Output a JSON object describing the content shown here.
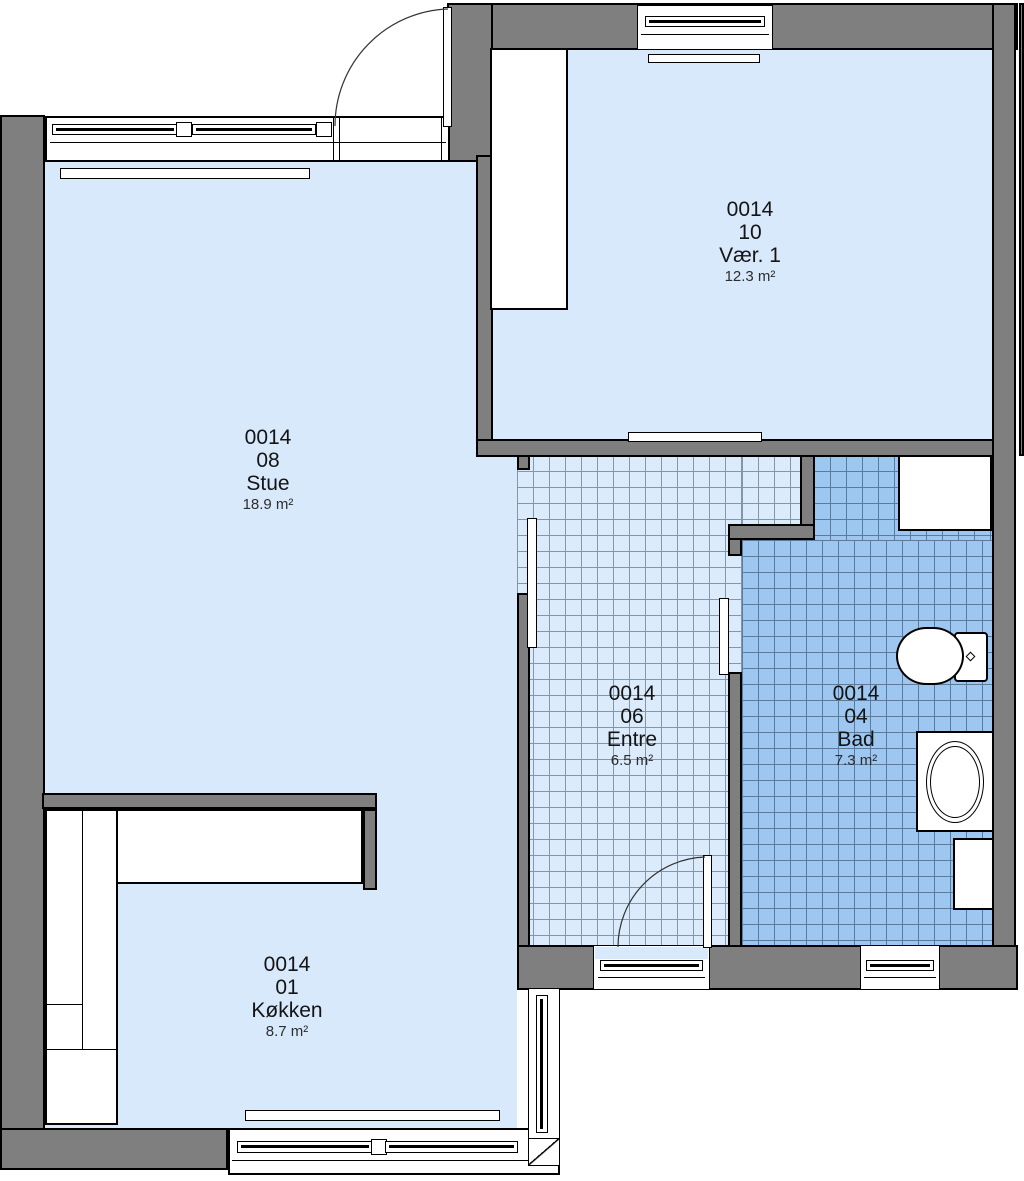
{
  "plan": {
    "type": "floor-plan",
    "rooms": [
      {
        "id": "stue",
        "number": "0014",
        "code": "08",
        "name": "Stue",
        "area": "18.9 m²"
      },
      {
        "id": "vaer1",
        "number": "0014",
        "code": "10",
        "name": "Vær. 1",
        "area": "12.3 m²"
      },
      {
        "id": "entre",
        "number": "0014",
        "code": "06",
        "name": "Entre",
        "area": "6.5 m²"
      },
      {
        "id": "bad",
        "number": "0014",
        "code": "04",
        "name": "Bad",
        "area": "7.3 m²"
      },
      {
        "id": "kokken",
        "number": "0014",
        "code": "01",
        "name": "Køkken",
        "area": "8.7 m²"
      }
    ],
    "colors": {
      "wall": "#7f7f7f",
      "outline": "#000000",
      "room_fill": "#d9e9fc",
      "entre_tile": "#dcebfb",
      "bad_tile": "#9dc6f0"
    }
  }
}
